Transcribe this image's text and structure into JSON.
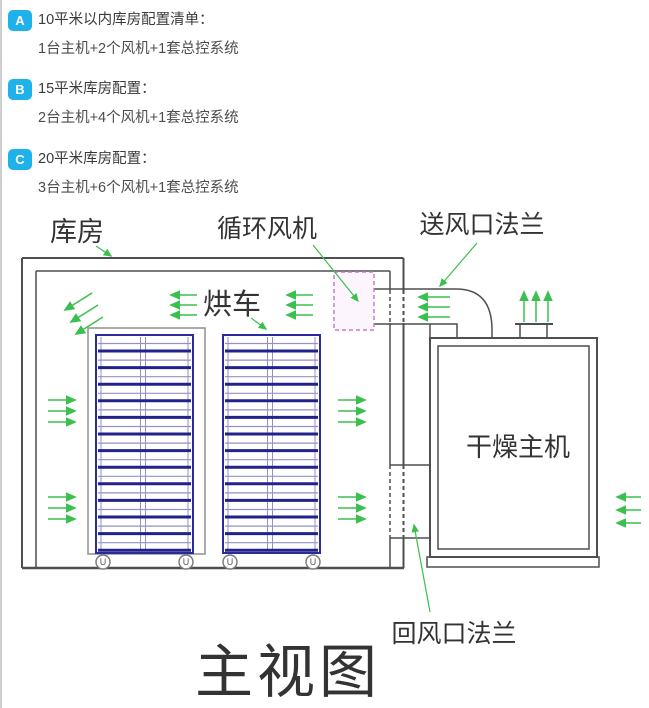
{
  "config_list": {
    "badge_color": "#1fb1e9",
    "items": [
      {
        "badge": "A",
        "title": "10平米以内库房配置清单：",
        "detail": "1台主机+2个风机+1套总控系统"
      },
      {
        "badge": "B",
        "title": "15平米库房配置：",
        "detail": "2台主机+4个风机+1套总控系统"
      },
      {
        "badge": "C",
        "title": "20平米库房配置：",
        "detail": "3台主机+6个风机+1套总控系统"
      }
    ]
  },
  "diagram": {
    "title": "主视图",
    "labels": {
      "warehouse": "库房",
      "circulation_fan": "循环风机",
      "supply_air_flange": "送风口法兰",
      "drying_cart": "烘车",
      "drying_host": "干燥主机",
      "return_air_flange": "回风口法兰"
    },
    "wheel_glyph": "U",
    "carts": {
      "count": 2,
      "shelf_rows": 13,
      "x_positions": [
        96,
        223
      ]
    },
    "colors": {
      "airflow_green": "#3bbf4f",
      "cart_blue": "#2b2b9e",
      "cart_bar_dark": "#22228c",
      "cart_line_light": "#9292c4",
      "outline_gray": "#4f4f4f",
      "fan_box_border_pink": "#c77fc7"
    }
  }
}
